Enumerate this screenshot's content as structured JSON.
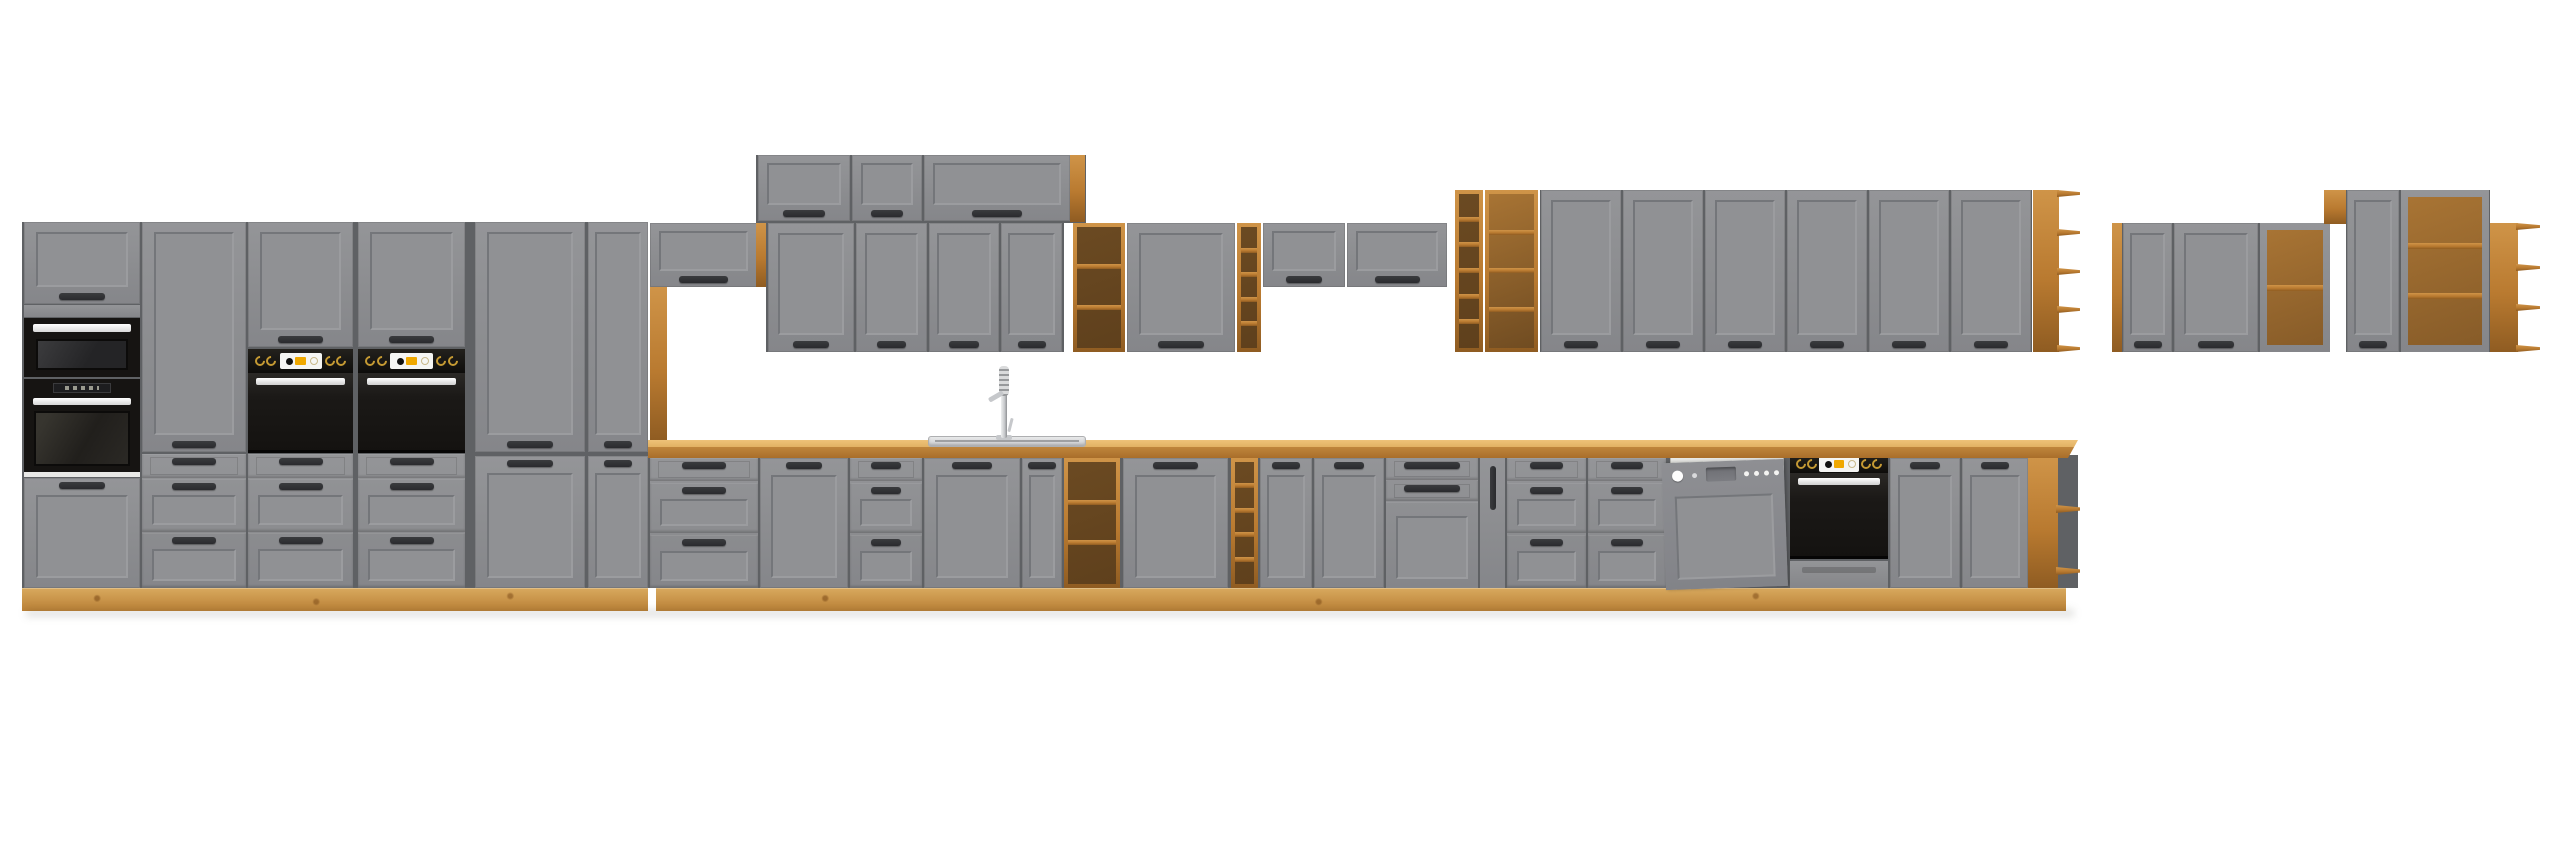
{
  "scene": {
    "title": "grey-oak-kitchen-cabinet-set-render",
    "background": "#ffffff",
    "canvas": {
      "width": 2560,
      "height": 848
    }
  },
  "palette": {
    "gray_face": "#8b8c8f",
    "gray_face_light": "#949598",
    "gray_panel": "#909194",
    "gray_frame_dark": "#74767a",
    "gray_frame_light": "#9b9c9f",
    "gray_side": "#7c7d80",
    "backing": "#5f6164",
    "handle": "#2a2b2e",
    "oak_light": "#cf9448",
    "oak_mid": "#b97a30",
    "oak_dark": "#8f5c22",
    "oak_plinth_light": "#d8a95e",
    "oak_plinth_dark": "#bb8136",
    "counter_top": "#e2b163",
    "counter_front": "#bf853c",
    "shelf_interior_dark": "#6b4a22",
    "shelf_interior_light": "#a87434",
    "appliance_black": "#161412",
    "oven_door": "#232120",
    "display_white": "#f5f5f3",
    "accent_amber": "#f0a800",
    "knob_gold": "#c59a33",
    "handle_bar_white": "#efefed",
    "dishwasher_tub": "#d8d8d4",
    "chrome": "#c6c8cb",
    "divider_white": "#e9e9e7"
  },
  "units": [
    {
      "n": "left-tall-block-backing",
      "t": "backing",
      "r": [
        22,
        222,
        626,
        366
      ]
    },
    {
      "n": "tower-top-door",
      "t": "door",
      "r": [
        24,
        222,
        116,
        82
      ],
      "o": {
        "handle": "bottom"
      }
    },
    {
      "n": "tower-rail",
      "t": "graypanel",
      "r": [
        24,
        305,
        116,
        12
      ]
    },
    {
      "n": "microwave",
      "t": "microwave",
      "r": [
        24,
        318,
        116,
        59
      ]
    },
    {
      "n": "tower-oven",
      "t": "toweroven",
      "r": [
        24,
        379,
        116,
        93
      ]
    },
    {
      "n": "tower-divider",
      "t": "lightpanel",
      "r": [
        24,
        472,
        116,
        5
      ]
    },
    {
      "n": "tower-bottom-door",
      "t": "door",
      "r": [
        24,
        478,
        116,
        110
      ],
      "o": {
        "handle": "top"
      }
    },
    {
      "n": "pantry-door-1",
      "t": "door",
      "r": [
        142,
        222,
        104,
        230
      ],
      "o": {
        "handle": "bottom"
      }
    },
    {
      "n": "drawer-stack-1",
      "t": "drawers",
      "r": [
        142,
        454,
        104,
        134
      ]
    },
    {
      "n": "oven-column-1-top-door",
      "t": "door",
      "r": [
        248,
        222,
        105,
        125
      ],
      "o": {
        "handle": "bottom"
      }
    },
    {
      "n": "oven-column-1-control-panel",
      "t": "ovenpanel",
      "r": [
        248,
        349,
        105,
        24
      ]
    },
    {
      "n": "oven-column-1-oven-door",
      "t": "ovendoor",
      "r": [
        248,
        373,
        105,
        80
      ]
    },
    {
      "n": "drawer-stack-2",
      "t": "drawers",
      "r": [
        248,
        454,
        105,
        134
      ]
    },
    {
      "n": "oven-column-2-top-door",
      "t": "door",
      "r": [
        358,
        222,
        107,
        125
      ],
      "o": {
        "handle": "bottom"
      }
    },
    {
      "n": "oven-column-2-control-panel",
      "t": "ovenpanel",
      "r": [
        358,
        349,
        107,
        24
      ]
    },
    {
      "n": "oven-column-2-oven-door",
      "t": "ovendoor",
      "r": [
        358,
        373,
        107,
        80
      ]
    },
    {
      "n": "drawer-stack-3",
      "t": "drawers",
      "r": [
        358,
        454,
        107,
        134
      ]
    },
    {
      "n": "pantry-door-2",
      "t": "door",
      "r": [
        475,
        222,
        110,
        230
      ],
      "o": {
        "handle": "bottom"
      }
    },
    {
      "n": "pantry-lower-door-1",
      "t": "door",
      "r": [
        475,
        456,
        110,
        132
      ],
      "o": {
        "handle": "top"
      }
    },
    {
      "n": "pantry-door-3",
      "t": "door",
      "r": [
        588,
        222,
        60,
        230
      ],
      "o": {
        "handle": "bottom"
      }
    },
    {
      "n": "pantry-lower-door-2",
      "t": "door",
      "r": [
        588,
        456,
        60,
        132
      ],
      "o": {
        "handle": "top"
      }
    },
    {
      "n": "left-plinth",
      "t": "plinth",
      "r": [
        22,
        588,
        626,
        23
      ]
    },
    {
      "n": "niche-wall-cabinet",
      "t": "flip",
      "r": [
        650,
        223,
        107,
        64
      ]
    },
    {
      "n": "niche-side-oak-panel",
      "t": "oak",
      "r": [
        650,
        287,
        17,
        154
      ]
    },
    {
      "n": "niche-oak-strip",
      "t": "oak",
      "r": [
        756,
        223,
        12,
        64
      ]
    },
    {
      "n": "top-flip-row-backing",
      "t": "backing",
      "r": [
        756,
        155,
        330,
        68
      ]
    },
    {
      "n": "top-flip-cabinet-1",
      "t": "flip",
      "r": [
        758,
        155,
        92,
        66
      ]
    },
    {
      "n": "top-flip-cabinet-2",
      "t": "flip",
      "r": [
        852,
        155,
        70,
        66
      ]
    },
    {
      "n": "top-flip-cabinet-3",
      "t": "flip",
      "r": [
        924,
        155,
        146,
        66
      ]
    },
    {
      "n": "top-flip-row-oak-side",
      "t": "oak",
      "r": [
        1070,
        155,
        15,
        67
      ]
    },
    {
      "n": "mid-wall-row-backing",
      "t": "backing",
      "r": [
        766,
        223,
        298,
        129
      ]
    },
    {
      "n": "mid-wall-door-1",
      "t": "door",
      "r": [
        768,
        223,
        86,
        129
      ],
      "o": {
        "handle": "bottom"
      }
    },
    {
      "n": "mid-wall-door-2",
      "t": "door",
      "r": [
        856,
        223,
        71,
        129
      ],
      "o": {
        "handle": "bottom"
      }
    },
    {
      "n": "mid-wall-door-3",
      "t": "door",
      "r": [
        929,
        223,
        70,
        129
      ],
      "o": {
        "handle": "bottom"
      }
    },
    {
      "n": "mid-wall-door-4",
      "t": "door",
      "r": [
        1001,
        223,
        61,
        129
      ],
      "o": {
        "handle": "bottom"
      }
    },
    {
      "n": "mid-wall-open-shelf",
      "t": "shelf",
      "r": [
        1073,
        223,
        52,
        129
      ],
      "o": {
        "comps": 3,
        "tone": "dark"
      }
    },
    {
      "n": "mid-wall-door-5",
      "t": "door",
      "r": [
        1127,
        223,
        108,
        129
      ],
      "o": {
        "handle": "bottom"
      }
    },
    {
      "n": "mid-wall-wine-column",
      "t": "shelf",
      "r": [
        1237,
        223,
        24,
        129
      ],
      "o": {
        "comps": 5,
        "tone": "dark"
      }
    },
    {
      "n": "low-flip-cabinet-1",
      "t": "flip",
      "r": [
        1263,
        223,
        82,
        64
      ]
    },
    {
      "n": "low-flip-cabinet-2",
      "t": "flip",
      "r": [
        1347,
        223,
        100,
        64
      ]
    },
    {
      "n": "right-wall-wine-column",
      "t": "shelf",
      "r": [
        1455,
        190,
        28,
        162
      ],
      "o": {
        "comps": 6,
        "tone": "dark"
      }
    },
    {
      "n": "right-wall-open-shelf",
      "t": "shelf",
      "r": [
        1485,
        190,
        53,
        162
      ],
      "o": {
        "comps": 4,
        "tone": "light"
      }
    },
    {
      "n": "right-wall-backing",
      "t": "backing",
      "r": [
        1540,
        190,
        492,
        162
      ]
    },
    {
      "n": "right-wall-door-1",
      "t": "door",
      "r": [
        1541,
        190,
        80,
        162
      ],
      "o": {
        "handle": "bottom"
      }
    },
    {
      "n": "right-wall-door-2",
      "t": "door",
      "r": [
        1623,
        190,
        80,
        162
      ],
      "o": {
        "handle": "bottom"
      }
    },
    {
      "n": "right-wall-door-3",
      "t": "door",
      "r": [
        1705,
        190,
        80,
        162
      ],
      "o": {
        "handle": "bottom"
      }
    },
    {
      "n": "right-wall-door-4",
      "t": "door",
      "r": [
        1787,
        190,
        80,
        162
      ],
      "o": {
        "handle": "bottom"
      }
    },
    {
      "n": "right-wall-door-5",
      "t": "door",
      "r": [
        1869,
        190,
        80,
        162
      ],
      "o": {
        "handle": "bottom"
      }
    },
    {
      "n": "right-wall-door-6",
      "t": "door",
      "r": [
        1951,
        190,
        80,
        162
      ],
      "o": {
        "handle": "bottom"
      }
    },
    {
      "n": "right-wall-end-shelf",
      "t": "endshelf",
      "r": [
        2033,
        190,
        47,
        162
      ],
      "o": {
        "comps": 4
      }
    },
    {
      "n": "far-right-oak-side",
      "t": "oak",
      "r": [
        2112,
        223,
        10,
        129
      ]
    },
    {
      "n": "far-right-backing-low",
      "t": "backing",
      "r": [
        2122,
        223,
        208,
        129
      ]
    },
    {
      "n": "far-right-door-1",
      "t": "door",
      "r": [
        2123,
        223,
        49,
        129
      ],
      "o": {
        "handle": "bottom"
      }
    },
    {
      "n": "far-right-door-2",
      "t": "door",
      "r": [
        2174,
        223,
        84,
        129
      ],
      "o": {
        "handle": "bottom"
      }
    },
    {
      "n": "far-right-open-unit-1",
      "t": "openframed",
      "r": [
        2260,
        223,
        70,
        129
      ],
      "o": {
        "comps": 2
      }
    },
    {
      "n": "far-right-oak-cap",
      "t": "oak",
      "r": [
        2324,
        190,
        26,
        34
      ]
    },
    {
      "n": "far-right-backing-high",
      "t": "backing",
      "r": [
        2346,
        190,
        144,
        162
      ]
    },
    {
      "n": "far-right-door-3",
      "t": "door",
      "r": [
        2347,
        190,
        52,
        162
      ],
      "o": {
        "handle": "bottom"
      }
    },
    {
      "n": "far-right-open-unit-2",
      "t": "openframed",
      "r": [
        2401,
        190,
        88,
        162
      ],
      "o": {
        "comps": 3
      }
    },
    {
      "n": "far-right-end-shelf",
      "t": "endshelf",
      "r": [
        2490,
        223,
        50,
        129
      ],
      "o": {
        "comps": 3
      }
    },
    {
      "n": "base-run-backing",
      "t": "backing",
      "r": [
        648,
        455,
        1430,
        133
      ]
    },
    {
      "n": "base-plinth",
      "t": "plinth",
      "r": [
        656,
        588,
        1410,
        23
      ]
    },
    {
      "n": "base-drawers-1",
      "t": "drawers",
      "r": [
        650,
        458,
        108,
        130
      ]
    },
    {
      "n": "base-door-1",
      "t": "door",
      "r": [
        760,
        458,
        88,
        130
      ],
      "o": {
        "handle": "top"
      }
    },
    {
      "n": "base-drawers-2",
      "t": "drawers",
      "r": [
        850,
        458,
        72,
        130
      ]
    },
    {
      "n": "sink-base-door-1",
      "t": "door",
      "r": [
        924,
        458,
        96,
        130
      ],
      "o": {
        "handle": "top"
      }
    },
    {
      "n": "sink-base-door-2",
      "t": "door",
      "r": [
        1022,
        458,
        40,
        130
      ],
      "o": {
        "handle": "top"
      }
    },
    {
      "n": "base-open-shelf",
      "t": "shelf",
      "r": [
        1064,
        458,
        56,
        130
      ],
      "o": {
        "comps": 3,
        "tone": "dark"
      }
    },
    {
      "n": "base-door-2",
      "t": "door",
      "r": [
        1123,
        458,
        105,
        130
      ],
      "o": {
        "handle": "top"
      }
    },
    {
      "n": "base-wine-column",
      "t": "shelf",
      "r": [
        1231,
        458,
        27,
        130
      ],
      "o": {
        "comps": 5,
        "tone": "dark"
      }
    },
    {
      "n": "base-door-3",
      "t": "door",
      "r": [
        1260,
        458,
        52,
        130
      ],
      "o": {
        "handle": "top"
      }
    },
    {
      "n": "base-door-4",
      "t": "door",
      "r": [
        1314,
        458,
        70,
        130
      ],
      "o": {
        "handle": "top"
      }
    },
    {
      "n": "base-drawer-combo",
      "t": "combodrawers",
      "r": [
        1386,
        458,
        92,
        130
      ]
    },
    {
      "n": "base-pullout-cabinet",
      "t": "pullout",
      "r": [
        1480,
        458,
        25,
        130
      ]
    },
    {
      "n": "base-drawers-3",
      "t": "drawers",
      "r": [
        1507,
        458,
        79,
        130
      ]
    },
    {
      "n": "base-drawers-4",
      "t": "drawers",
      "r": [
        1588,
        458,
        78,
        130
      ]
    },
    {
      "n": "dishwasher",
      "t": "dishwasher",
      "r": [
        1666,
        452,
        122,
        136
      ]
    },
    {
      "n": "base-oven",
      "t": "baseoven",
      "r": [
        1790,
        455,
        98,
        133
      ]
    },
    {
      "n": "base-door-5",
      "t": "door",
      "r": [
        1890,
        458,
        70,
        130
      ],
      "o": {
        "handle": "top"
      }
    },
    {
      "n": "base-door-6",
      "t": "door",
      "r": [
        1962,
        458,
        66,
        130
      ],
      "o": {
        "handle": "top"
      }
    },
    {
      "n": "base-end-shelf",
      "t": "endshelfbase",
      "r": [
        2028,
        458,
        50,
        130
      ],
      "o": {
        "comps": 2
      }
    },
    {
      "n": "countertop",
      "t": "counter",
      "r": [
        648,
        440,
        1430,
        18
      ],
      "o": {
        "cutRight": true
      }
    },
    {
      "n": "sink",
      "t": "sink",
      "r": [
        928,
        436,
        158,
        11
      ]
    },
    {
      "n": "faucet",
      "t": "faucet",
      "r": [
        983,
        360,
        42,
        80
      ]
    },
    {
      "n": "floor-shadow",
      "t": "shadow",
      "r": [
        26,
        609,
        2048,
        8
      ]
    }
  ]
}
